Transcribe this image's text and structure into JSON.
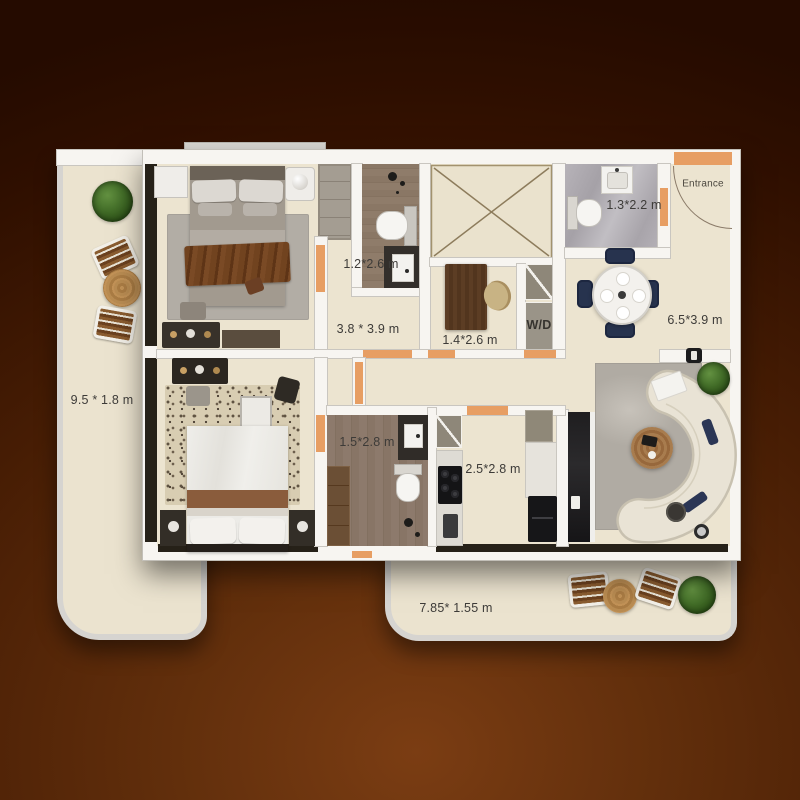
{
  "scene": {
    "type": "apartment-floor-plan-top-view"
  },
  "labels": {
    "balcony_left": "9.5 * 1.8 m",
    "bedroom_1": "3.8 * 3.9 m",
    "bathroom_1": "1.2*2.6 m",
    "study": "1.4*2.6 m",
    "laundry": "W/D",
    "bathroom_2": "1.3*2.2 m",
    "entrance": "Entrance",
    "living_dining": "6.5*3.9 m",
    "bathroom_3": "1.5*2.8 m",
    "kitchen": "2.5*2.8 m",
    "balcony_bottom": "7.85* 1.55 m"
  },
  "colors": {
    "background_dark": "#2a0d00",
    "background_light": "#7b3d13",
    "wall_white": "#f7f5f1",
    "wall_edge": "#c9c6c0",
    "floor_cream": "#ece4d0",
    "door_marker_orange": "#e79e63",
    "window_glass_dark": "#262118",
    "wood_floor": "#8d7a6a",
    "marble_floor": "#b0acb2",
    "rug_gray": "#b5b0a8",
    "sofa_cream": "#e9e3d5",
    "navy_chair": "#27334e",
    "plant_green": "#45702a",
    "label_text": "#3d3b38"
  }
}
